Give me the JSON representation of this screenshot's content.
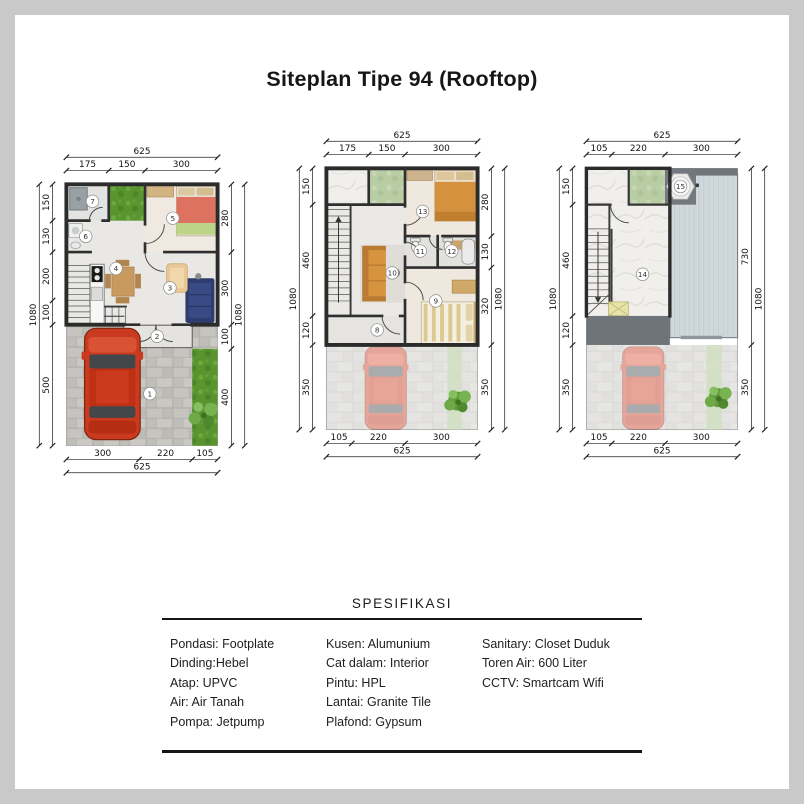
{
  "page": {
    "title": "Siteplan Tipe 94 (Rooftop)"
  },
  "colors": {
    "wall": "#2b2b2b",
    "car": "#c93a1e",
    "grass": "#59942f",
    "roof": "#d3dade",
    "canopy": "#6e747a"
  },
  "plans": [
    {
      "id": "ground-floor",
      "rooms": [
        "1",
        "2",
        "3",
        "4",
        "5",
        "6",
        "7"
      ],
      "dims": {
        "top_tot": [
          "625"
        ],
        "top_seg": [
          "175",
          "150",
          "300"
        ],
        "bottom_seg": [
          "300",
          "220",
          "105"
        ],
        "bottom_tot": [
          "625"
        ],
        "left_seg": [
          "150",
          "130",
          "200",
          "100",
          "500"
        ],
        "left_tot": [
          "1080"
        ],
        "right_seg": [
          "280",
          "300",
          "100",
          "400"
        ],
        "right_tot": [
          "1080"
        ]
      }
    },
    {
      "id": "second-floor",
      "rooms": [
        "8",
        "9",
        "10",
        "11",
        "12",
        "13"
      ],
      "dims": {
        "top_tot": [
          "625"
        ],
        "top_seg": [
          "175",
          "150",
          "300"
        ],
        "bottom_seg": [
          "105",
          "220",
          "300"
        ],
        "bottom_tot": [
          "625"
        ],
        "left_seg": [
          "150",
          "460",
          "120",
          "350"
        ],
        "left_tot": [
          "1080"
        ],
        "right_seg": [
          "280",
          "130",
          "320",
          "350"
        ],
        "right_tot": [
          "1080"
        ]
      }
    },
    {
      "id": "rooftop",
      "rooms": [
        "14",
        "15"
      ],
      "dims": {
        "top_tot": [
          "625"
        ],
        "top_seg": [
          "105",
          "220",
          "300"
        ],
        "bottom_seg": [
          "105",
          "220",
          "300"
        ],
        "bottom_tot": [
          "625"
        ],
        "left_seg": [
          "150",
          "460",
          "120",
          "350"
        ],
        "left_tot": [
          "1080"
        ],
        "right_seg": [
          "730",
          "350"
        ],
        "right_tot": [
          "1080"
        ]
      }
    }
  ],
  "specifications": {
    "title": "SPESIFIKASI",
    "columns": [
      [
        "Pondasi: Footplate",
        "Dinding:Hebel",
        "Atap: UPVC",
        "Air: Air Tanah",
        "Pompa: Jetpump"
      ],
      [
        "Kusen: Alumunium",
        "Cat dalam: Interior",
        "Pintu: HPL",
        "Lantai: Granite Tile",
        "Plafond: Gypsum"
      ],
      [
        "Sanitary: Closet Duduk",
        "Toren Air: 600 Liter",
        "CCTV: Smartcam Wifi"
      ]
    ]
  }
}
